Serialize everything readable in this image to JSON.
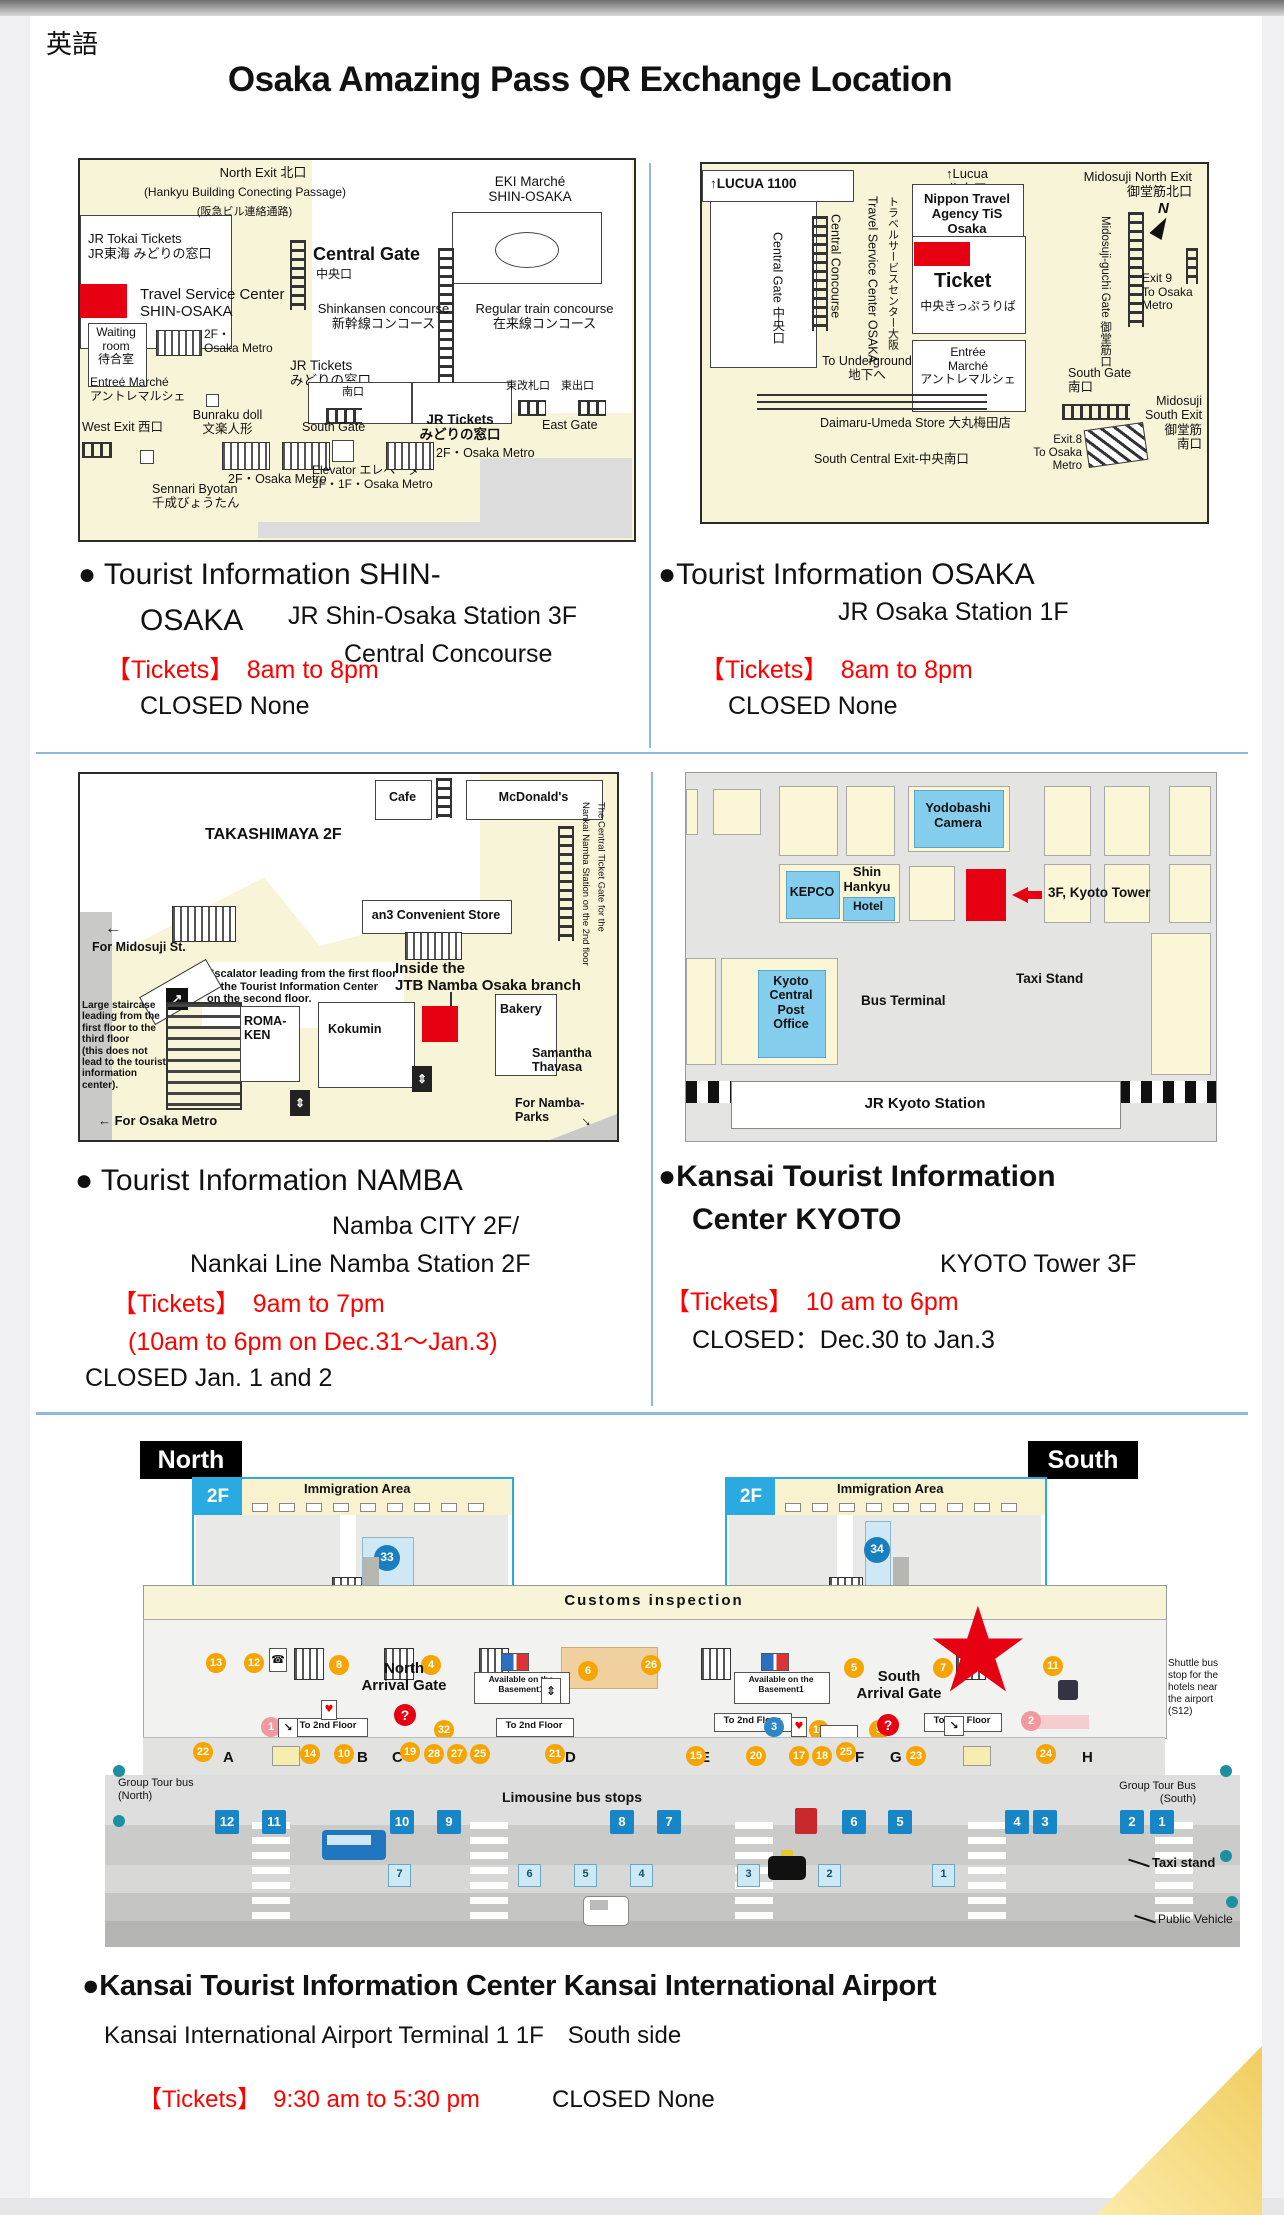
{
  "header": {
    "lang": "英語",
    "title": "Osaka Amazing Pass QR Exchange Location"
  },
  "shin_osaka": {
    "map": {
      "north_exit": "North Exit 北口",
      "hankyu_en": "(Hankyu Building Conecting Passage)",
      "hankyu_jp": "(阪急ビル連絡通路)",
      "jr_tokai": "JR Tokai Tickets\nJR東海 みどりの窓口",
      "eki_marche": "EKI Marché\nSHIN-OSAKA",
      "central_gate": "Central Gate",
      "central_gate_jp": "中央口",
      "tsc": "Travel Service Center\nSHIN-OSAKA",
      "waiting": "Waiting\nroom\n待合室",
      "metro_a": "2F・\nOsaka Metro",
      "shinkansen": "Shinkansen concourse\n新幹線コンコース",
      "regular": "Regular train concourse\n在来線コンコース",
      "jr_tickets_a": "JR Tickets\nみどりの窓口",
      "entree": "Entreé Marché\nアントレマルシェ",
      "west_exit": "West Exit 西口",
      "bunraku": "Bunraku doll\n文楽人形",
      "south_gate_jp": "南口",
      "south_gate": "South Gate",
      "jr_tickets_b": "JR Tickets\nみどりの窓口",
      "east_jp": "東改札口　東出口",
      "east_gate": "East Gate",
      "metro_b": "2F・Osaka Metro",
      "elevator": "Elevator エレベーター\n2F・1F・Osaka Metro",
      "metro_c": "2F・Osaka Metro",
      "sennari": "Sennari Byotan\n千成びょうたん"
    },
    "info": {
      "name": "● Tourist Information  SHIN-",
      "name2": "OSAKA",
      "loc1": "JR Shin-Osaka Station 3F",
      "loc2": "Central Concourse",
      "tickets": "【Tickets】　8am to 8pm",
      "closed": "CLOSED None"
    }
  },
  "osaka": {
    "map": {
      "lucua1100": "↑LUCUA 1100",
      "lucua": "↑Lucua\nルクア",
      "midosuji_north": "Midosuji North Exit\n御堂筋北口",
      "compass": "N",
      "central_gate_v": "Central Gate 中央口",
      "central_concourse_v": "Central Concourse",
      "tsc_en_v": "Travel Service Center OSAKA",
      "tsc_jp_v": "トラベルサービスセンター大阪",
      "nippon": "Nippon Travel\nAgency TiS Osaka",
      "ticket": "Ticket",
      "ticket_jp": "中央きっぷうりば",
      "entree": "Entrée\nMarché\nアントレマルシェ",
      "midosuji_guchi_v": "Midosuji-guchi Gate 御堂筋口",
      "exit9": "Exit 9\nTo Osaka\nMetro",
      "underground": "To Underground\n地下へ",
      "south_gate": "South Gate\n南口",
      "daimaru": "Daimaru-Umeda Store 大丸梅田店",
      "south_central": "South Central Exit-中央南口",
      "exit8": "Exit.8\nTo Osaka Metro",
      "midosuji_south": "Midosuji\nSouth Exit\n御堂筋\n南口"
    },
    "info": {
      "name": "●Tourist Information OSAKA",
      "loc": "JR Osaka Station 1F",
      "tickets": "【Tickets】　8am to 8pm",
      "closed": "CLOSED None"
    }
  },
  "namba": {
    "map": {
      "takashimaya": "TAKASHIMAYA 2F",
      "cafe": "Cafe",
      "mcdonalds": "McDonald's",
      "nankai_v": "The Central Ticket Gate for the\nNankai Namba Station on the 2nd floor",
      "an3": "an3 Convenient Store",
      "for_midosuji": "For Midosuji St.",
      "escalator_note": "Escalator leading from the first floor\nto the Tourist Information Center\non the second floor.",
      "inside_jtb": "Inside the\nJTB Namba Osaka branch",
      "staircase_note": "Large staircase\nleading from the\nfirst floor to the\nthird floor\n(this does not\nlead to the tourist\ninformation\ncenter).",
      "romaken": "ROMA-\nKEN",
      "kokumin": "Kokumin",
      "bakery": "Bakery",
      "samantha": "Samantha\nThavasa",
      "namba_parks": "For Namba-Parks",
      "osaka_metro": "← For Osaka Metro"
    },
    "info": {
      "name": "● Tourist Information NAMBA",
      "loc1": "Namba CITY 2F/",
      "loc2": "Nankai Line Namba Station 2F",
      "tickets1": "【Tickets】　9am to 7pm",
      "tickets2": "(10am to 6pm on Dec.31～Jan.3)",
      "closed": "CLOSED  Jan. 1 and 2"
    }
  },
  "kyoto": {
    "map": {
      "yodobashi": "Yodobashi\nCamera",
      "kepco": "KEPCO",
      "shin_hankyu": "Shin\nHankyu",
      "hotel": "Hotel",
      "kyoto_tower": "3F, Kyoto Tower",
      "post": "Kyoto\nCentral\nPost\nOffice",
      "bus_terminal": "Bus Terminal",
      "taxi_stand": "Taxi Stand",
      "jr_kyoto": "JR Kyoto Station"
    },
    "info": {
      "name1": "●Kansai Tourist Information",
      "name2": "Center  KYOTO",
      "loc": "KYOTO Tower 3F",
      "tickets": "【Tickets】　10 am to 6pm",
      "closed": "CLOSED：Dec.30 to Jan.3"
    }
  },
  "airport": {
    "north": "North",
    "south": "South",
    "f2": "2F",
    "immigration": "Immigration Area",
    "m33": "33",
    "m34": "34",
    "customs": "Customs inspection",
    "north_gate": "North\nArrival Gate",
    "south_gate": "South\nArrival Gate",
    "question": "?",
    "basement1": "Available on the\nBasement1",
    "to_2nd_floor": "To 2nd Floor",
    "shuttle": "Shuttle bus\nstop for the\nhotels near\nthe airport\n(S12)",
    "gt_north": "Group Tour bus\n(North)",
    "gt_south": "Group Tour Bus\n(South)",
    "limousine": "Limousine bus stops",
    "taxi": "Taxi stand",
    "public_vehicle": "Public Vehicle",
    "letters": [
      "A",
      "B",
      "C",
      "D",
      "E",
      "F",
      "G",
      "H"
    ],
    "strip_markers": [
      "13",
      "12",
      "8",
      "4",
      "6",
      "26",
      "5",
      "7",
      "11",
      "32",
      "16",
      "9"
    ],
    "curb_markers": [
      "22",
      "14",
      "10",
      "19",
      "28",
      "27",
      "25",
      "21",
      "15",
      "20",
      "17",
      "18",
      "25",
      "23",
      "24"
    ],
    "pink": [
      "1",
      "2"
    ],
    "blue3": "3",
    "row1": [
      "12",
      "11",
      "10",
      "9",
      "8",
      "7",
      "6",
      "5",
      "4",
      "3",
      "2",
      "1"
    ],
    "row2": [
      "7",
      "6",
      "5",
      "4",
      "3",
      "2",
      "1"
    ],
    "info": {
      "name": "●Kansai Tourist Information Center Kansai International Airport",
      "loc": "Kansai International Airport Terminal 1 1F　South side",
      "tickets": "【Tickets】　9:30 am to 5:30 pm",
      "closed": "CLOSED None"
    }
  }
}
